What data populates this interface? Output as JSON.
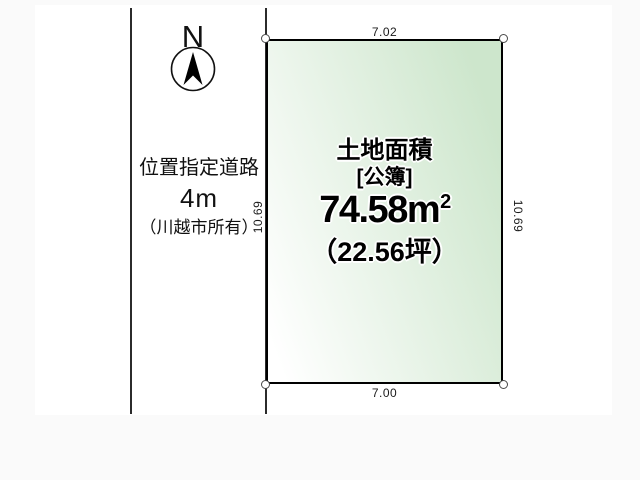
{
  "page": {
    "background": "#fafafa",
    "canvas_background": "#ffffff"
  },
  "compass": {
    "label": "N"
  },
  "road": {
    "name": "位置指定道路",
    "width": "4m",
    "owner": "（川越市所有）"
  },
  "plot": {
    "area_title": "土地面積",
    "register_label": "[公簿]",
    "area_m2": "74.58m",
    "area_m2_sup": "2",
    "area_tsubo": "（22.56坪）",
    "colors": {
      "fill_light": "#ffffff",
      "fill_green": "#cde6cc",
      "border": "#000000"
    },
    "dimensions": {
      "top": "7.02",
      "bottom": "7.00",
      "left": "10.69",
      "right": "10.69"
    }
  }
}
